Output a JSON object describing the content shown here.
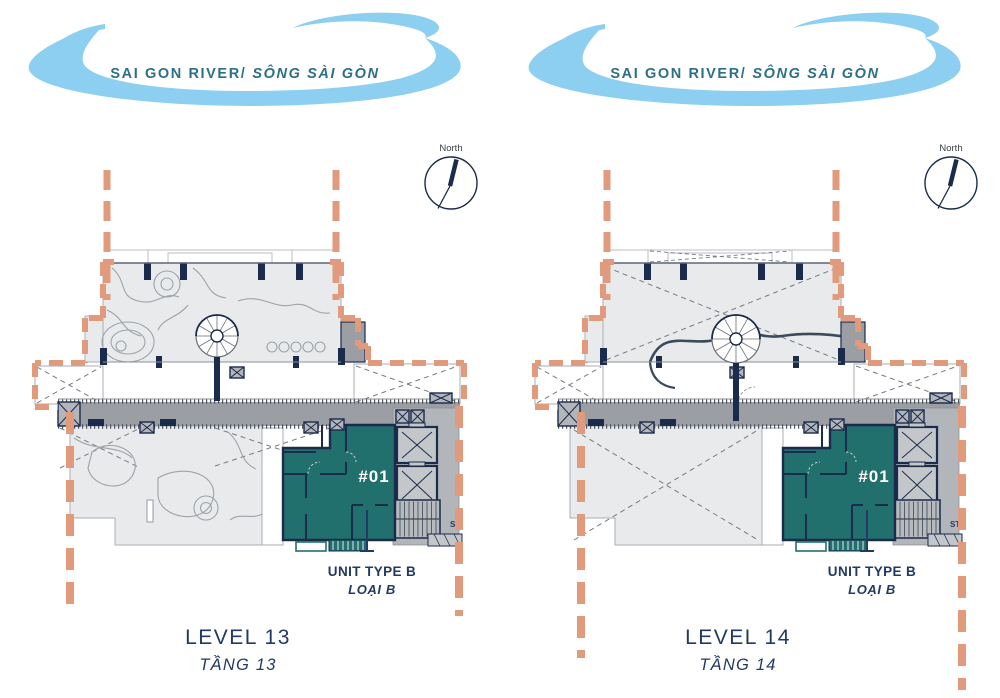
{
  "colors": {
    "river_blue": "#8DCFF0",
    "river_text": "#2D6F87",
    "salmon": "#E29A7C",
    "navy": "#1B2B4C",
    "label_navy": "#223A63",
    "teal_unit": "#21706D",
    "floor_light": "#E9EAEC",
    "floor_outline": "#A9AEB4",
    "corridor_gray": "#9B9EA2",
    "core_gray": "#B2B5B9",
    "brace_gray": "#767B82",
    "compass_text": "#3B4148"
  },
  "river": {
    "label_en": "SAI GON RIVER/",
    "label_vi": "SÔNG SÀI GÒN"
  },
  "compass_label": "North",
  "panels": [
    {
      "id": "level-13",
      "variant": "garden",
      "level_label": "LEVEL 13",
      "level_label_vi": "TẦNG 13",
      "unit_number": "#01",
      "unit_type_label": "UNIT TYPE B",
      "unit_type_label_vi": "LOẠI B",
      "stair_label": "ST"
    },
    {
      "id": "level-14",
      "variant": "open",
      "level_label": "LEVEL 14",
      "level_label_vi": "TẦNG 14",
      "unit_number": "#01",
      "unit_type_label": "UNIT TYPE B",
      "unit_type_label_vi": "LOẠI B",
      "stair_label": "ST"
    }
  ]
}
